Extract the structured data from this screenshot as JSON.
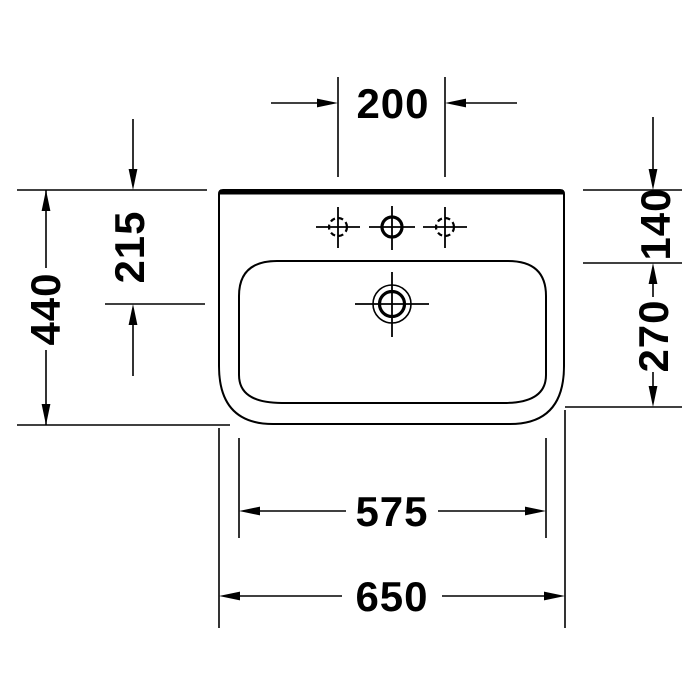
{
  "page": {
    "background": "#ffffff",
    "ink": "#000000"
  },
  "drawing": {
    "subject": "washbasin-top-view-dimension-drawing",
    "units": "mm",
    "dimensions": {
      "tap_hole_spacing": {
        "label": "200",
        "meaning": "spacing between side tap holes"
      },
      "rim_to_overflow": {
        "label": "215",
        "meaning": "back edge to overflow hole center"
      },
      "overall_depth": {
        "label": "440",
        "meaning": "overall depth front to back"
      },
      "rim_to_bowl_top": {
        "label": "140",
        "meaning": "back edge to inner bowl top"
      },
      "bowl_depth": {
        "label": "270",
        "meaning": "inner bowl depth"
      },
      "bowl_width": {
        "label": "575",
        "meaning": "inner bowl width"
      },
      "overall_width": {
        "label": "650",
        "meaning": "overall width"
      }
    }
  }
}
